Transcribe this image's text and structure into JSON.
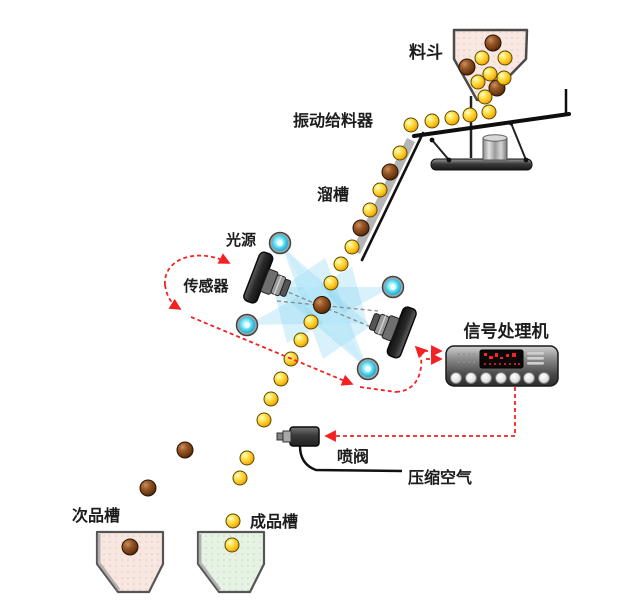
{
  "labels": {
    "hopper": "料斗",
    "vibrating_feeder": "振动给料器",
    "chute": "溜槽",
    "light_source": "光源",
    "sensor": "传感器",
    "signal_processor": "信号处理机",
    "spray_valve": "喷阀",
    "compressed_air": "压缩空气",
    "reject_bin": "次品槽",
    "product_bin": "成品槽"
  },
  "colors": {
    "accept_ball": "#fcc92a",
    "reject_ball": "#6e3a12",
    "hopper_fill": "#f9e8e2",
    "reject_bin_fill": "#f8e6e0",
    "product_bin_fill": "#e6f2e4",
    "light_beam": "#8ed7f0",
    "lamp": "#30c4e8",
    "signal_path": "#f22222",
    "led_display": "#ff2020"
  }
}
